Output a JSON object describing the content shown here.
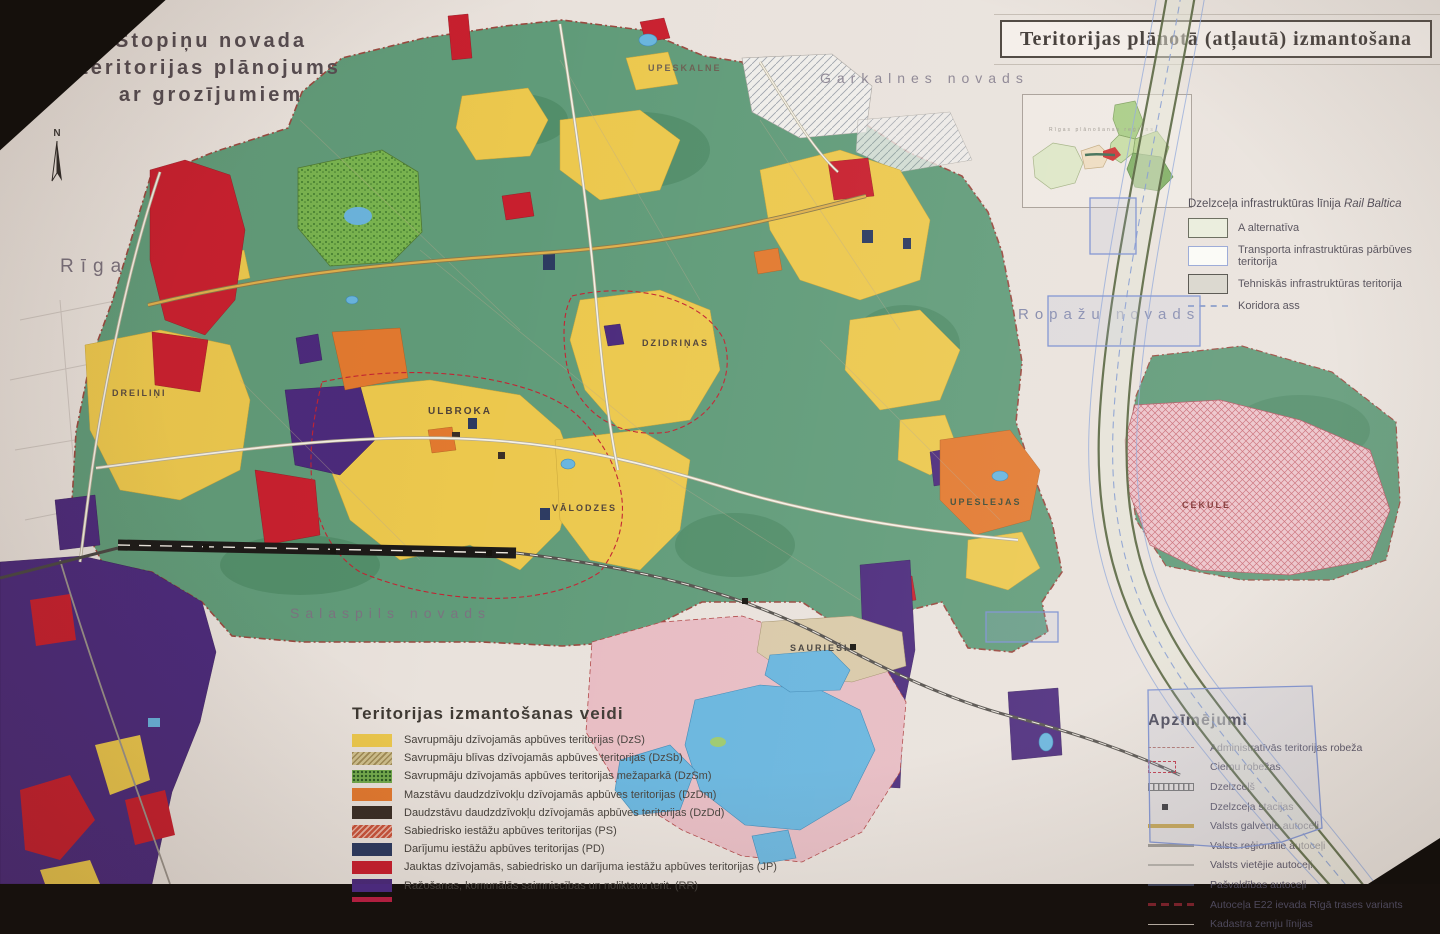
{
  "title": {
    "line1": "Stopiņu novada",
    "line2": "teritorijas plānojums",
    "line3": "ar grozījumiem"
  },
  "north_label": "N",
  "header": {
    "title": "Teritorijas plānotā (atļautā) izmantošana"
  },
  "inset": {
    "caption": "Rīgas plānošanas reģions"
  },
  "neighbors": {
    "riga": "Rīga",
    "garkalne": "Garkalnes novads",
    "ropazi": "Ropažu novads",
    "salaspils": "Salaspils novads"
  },
  "villages": {
    "dreilini": "DREILIŅI",
    "ulbroka": "ULBROKA",
    "valodzes": "VĀLODZES",
    "dzidrinas": "DZIDRIŅAS",
    "upeslejas": "UPESLEJAS",
    "sauriesi": "SAURIEŠI",
    "upeskalne": "UPESKALNE",
    "cekule": "CEKULE"
  },
  "rail_baltica_legend": {
    "title": "Dzelzceļa infrastruktūras līnija ",
    "title_italic": "Rail Baltica",
    "items": [
      {
        "label": "A alternatīva",
        "color": "#e9ecdb"
      },
      {
        "label": "Transporta infrastruktūras pārbūves teritorija",
        "color": "#fbfbf7"
      },
      {
        "label": "Tehniskās infrastruktūras teritorija",
        "color": "#d8d5cc"
      },
      {
        "label": "Koridora ass",
        "symbol": "dashed-line"
      }
    ]
  },
  "land_use_legend": {
    "title": "Teritorijas izmantošanas veidi",
    "items": [
      {
        "label": "Savrupmāju dzīvojamās apbūves teritorijas (DzS)",
        "color": "#ecc84d",
        "pattern": "solid"
      },
      {
        "label": "Savrupmāju blīvas dzīvojamās apbūves teritorijas (DzSb)",
        "color": "#cfc08d",
        "pattern": "hatch"
      },
      {
        "label": "Savrupmāju dzīvojamās apbūves teritorijas mežaparkā (DzSm)",
        "color": "#74ac4e",
        "pattern": "speckle"
      },
      {
        "label": "Mazstāvu daudzdzīvokļu dzīvojamās apbūves teritorijas (DzDm)",
        "color": "#e2792f",
        "pattern": "solid"
      },
      {
        "label": "Daudzstāvu daudzdzīvokļu dzīvojamās apbūves teritorijas (DzDd)",
        "color": "#3a2e26",
        "pattern": "solid"
      },
      {
        "label": "Sabiedrisko iestāžu apbūves teritorijas (PS)",
        "color": "#c9543c",
        "pattern": "hatch-light"
      },
      {
        "label": "Darījumu iestāžu apbūves teritorijas (PD)",
        "color": "#2c3a60",
        "pattern": "solid"
      },
      {
        "label": "Jauktas dzīvojamās, sabiedrisko un darījuma iestāžu apbūves teritorijas (JP)",
        "color": "#c81f2e",
        "pattern": "solid"
      },
      {
        "label": "Ražošanas, komunālās saimniecības un noliktavu terit. (RR)",
        "color": "#4b2a7c",
        "pattern": "solid"
      }
    ],
    "partial_color": "#b01f3f"
  },
  "symbols_legend": {
    "title": "Apzīmējumi",
    "items": [
      {
        "symbol": "admin-boundary",
        "label": "Administratīvās teritorijas robeža"
      },
      {
        "symbol": "village-boundary",
        "label": "Ciemu robežas"
      },
      {
        "symbol": "railway",
        "label": "Dzelzceļš"
      },
      {
        "symbol": "railway-station",
        "label": "Dzelzceļa stacijas"
      },
      {
        "symbol": "state-main-road",
        "label": "Valsts galvenie autoceļi"
      },
      {
        "symbol": "state-regional-road",
        "label": "Valsts reģionālie autoceļi"
      },
      {
        "symbol": "state-local-road",
        "label": "Valsts vietējie autoceļi"
      },
      {
        "symbol": "municipal-road",
        "label": "Pašvaldības autoceļi"
      },
      {
        "symbol": "e22-route-variant",
        "label": "Autoceļa E22 ievada Rīgā trases variants"
      },
      {
        "symbol": "cadastre-lines",
        "label": "Kadastra zemju līnijas"
      }
    ]
  },
  "colors": {
    "paper": "#e9e2dc",
    "forest_green": "#609b79",
    "forest_dark": "#4e8a66",
    "park_green": "#79b44f",
    "residential_yellow": "#ecc84d",
    "mixed_red": "#c81f2e",
    "industry_purple": "#4b2a7c",
    "business_navy": "#2c3a60",
    "lowrise_orange": "#e2792f",
    "water_blue": "#68b5de",
    "pink_area": "#ecc3ca",
    "corridor_olive": "#4b5a33",
    "overlay_blue": "#7b8fd0",
    "boundary_red": "#99493f"
  }
}
